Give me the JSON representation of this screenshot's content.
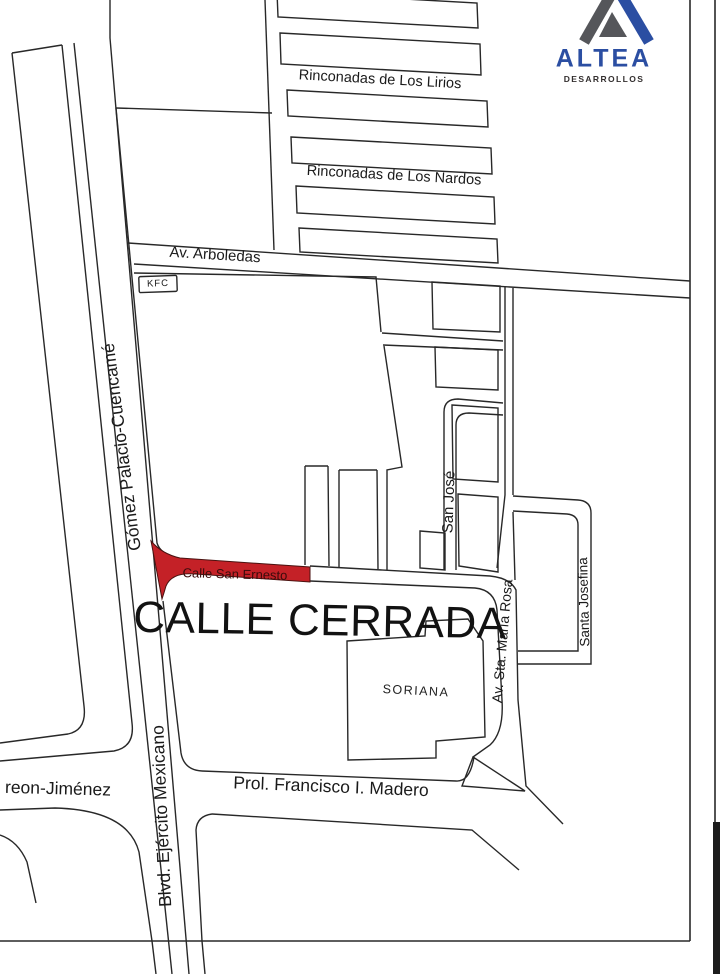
{
  "logo": {
    "brand": "ALTEA",
    "subtitle": "DESARROLLOS",
    "brand_color": "#2b4ea2",
    "mark_gray": "#55565a"
  },
  "map": {
    "highlight_color": "#c42127",
    "line_color": "#282828",
    "labels": {
      "lirios": "Rinconadas de Los Lirios",
      "nardos": "Rinconadas de Los Nardos",
      "arboledas": "Av. Arboledas",
      "kfc": "KFC",
      "gomez": "Gómez Palacio-Cuencamé",
      "san_ernesto": "Calle San Ernesto",
      "calle_cerrada": "CALLE CERRADA",
      "san_jose": "San José",
      "sta_maria_rosa": "Av. Sta. María Rosa",
      "santa_josefina": "Santa Josefina",
      "soriana": "SORIANA",
      "madero": "Prol. Francisco I. Madero",
      "jimenez": "reon-Jiménez",
      "ejercito": "Blvd. Ejército Mexicano"
    }
  }
}
